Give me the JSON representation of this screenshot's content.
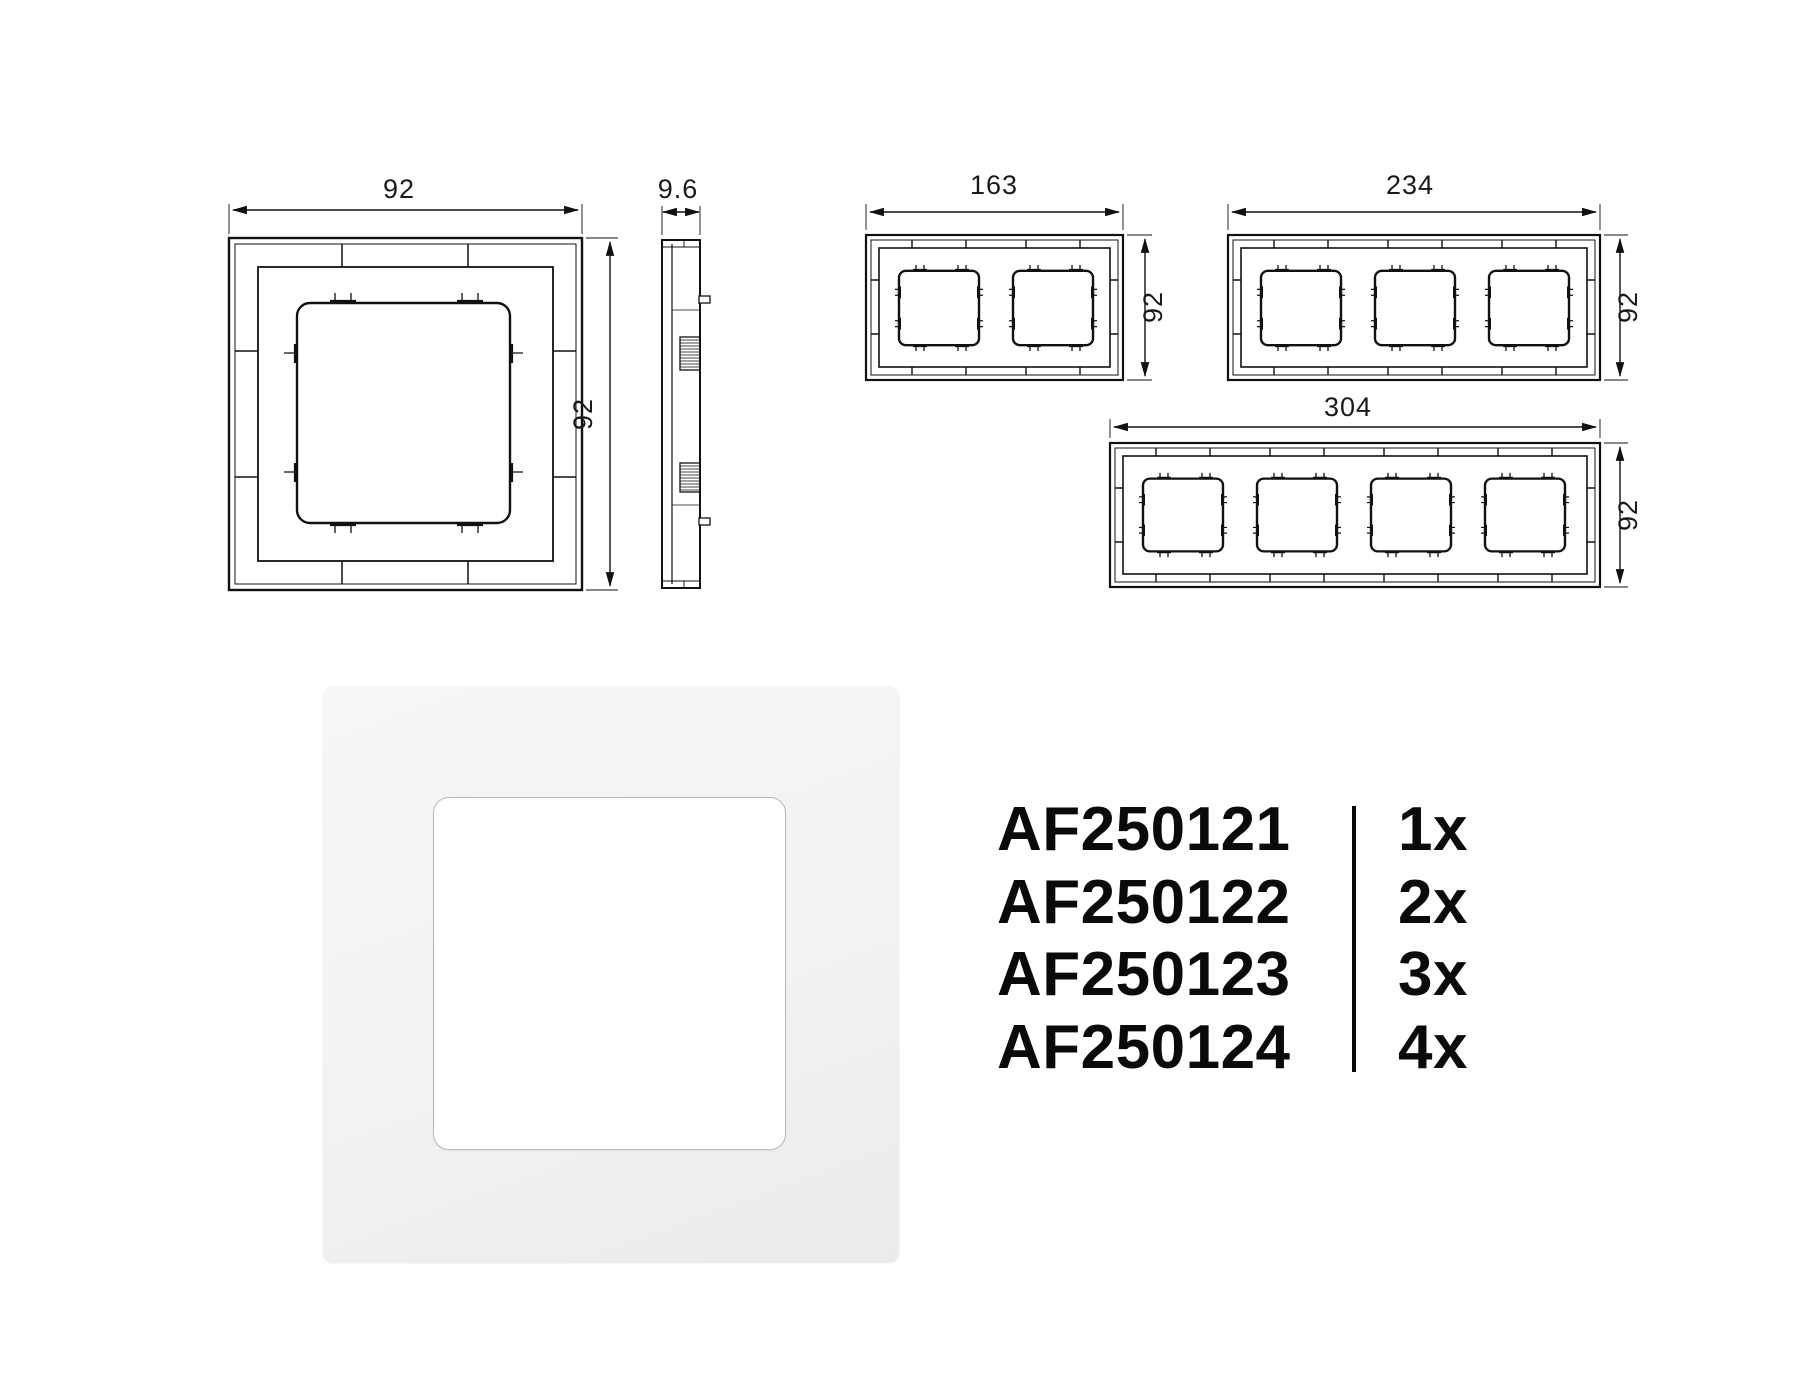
{
  "dimensions": {
    "single": {
      "width": "92",
      "height": "92",
      "depth": "9.6"
    },
    "two_gang": {
      "width": "163",
      "height": "92"
    },
    "three_gang": {
      "width": "234",
      "height": "92"
    },
    "four_gang": {
      "width": "304",
      "height": "92"
    }
  },
  "product_list": {
    "rows": [
      {
        "code": "AF250121",
        "quantity": "1x"
      },
      {
        "code": "AF250122",
        "quantity": "2x"
      },
      {
        "code": "AF250123",
        "quantity": "3x"
      },
      {
        "code": "AF250124",
        "quantity": "4x"
      }
    ]
  },
  "colors": {
    "line": "#111111",
    "dimension_text": "#1a1a1a",
    "photo_frame": "#f3f3f3",
    "photo_rim": "#b9b9b9",
    "list_text": "#0a0a0a",
    "background": "#ffffff"
  }
}
